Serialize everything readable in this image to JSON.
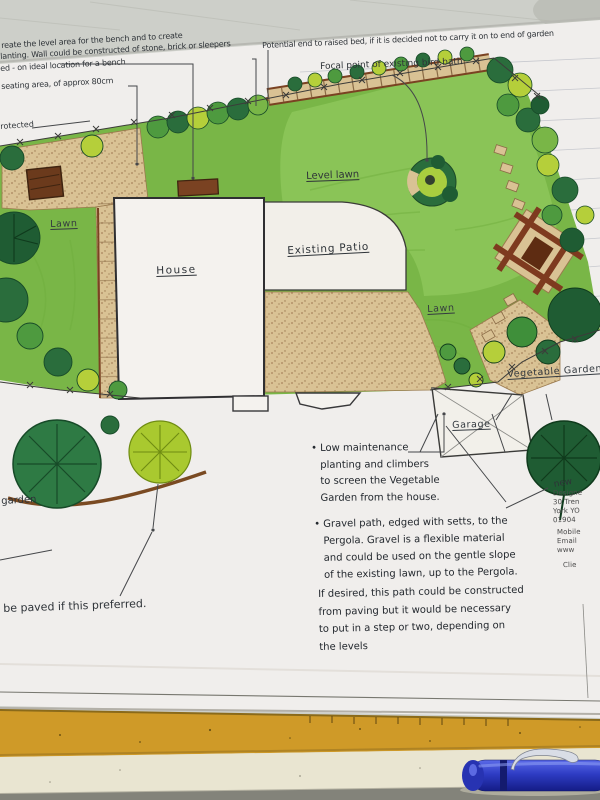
{
  "handwritten": {
    "top_left_lines": [
      "reate the level area for the bench and to create",
      "lanting. Wall could be constructed of stone, brick or sleepers",
      "ed - on ideal location for a bench",
      "seating area, of approx 80cm"
    ],
    "protected_fragment": "rotected",
    "potential_end_note": "Potential end to raised bed, if it is decided not to carry it on to end of garden",
    "focal_point_note": "Focal point of existing bird bath",
    "garden_fragment": "garden",
    "new_fragment": "new",
    "paved_note": "be paved if this preferred."
  },
  "labels": {
    "lawn_left": "Lawn",
    "level_lawn": "Level lawn",
    "house": "House",
    "existing_patio": "Existing Patio",
    "lawn_right": "Lawn",
    "vegetable_garden": "Vegetable Garden",
    "garage": "Garage"
  },
  "notes": {
    "note1_lines": [
      "• Low maintenance",
      "planting and climbers",
      "to screen the Vegetable",
      "Garden from the house."
    ],
    "note2_lines": [
      "• Gravel path, edged with setts,  to the",
      "Pergola. Gravel is a flexible material",
      "and could be used on the gentle slope",
      "of the existing lawn, up to the Pergola."
    ],
    "note3_lines": [
      "If desired, this path could be constructed",
      "from paving but it would be necessary",
      "to put in a step or two, depending on",
      "the levels"
    ]
  },
  "title_block": {
    "lines": [
      "Designe",
      "30 Tren",
      "York YO",
      "01904",
      "Mobile",
      "Email",
      "www",
      "Clie"
    ]
  },
  "colors": {
    "paper": "#f0eeec",
    "table": "#cdcfc9",
    "lawn": "#79b647",
    "level_lawn": "#8ac457",
    "tree_dark": "#1f5c33",
    "tree_mid": "#3f8f3a",
    "tree_light": "#b5cf3a",
    "gravel": "#d9c294",
    "timber": "#7a4222",
    "ink": "#2e3338",
    "ruler": "#cf9a28",
    "pen_blue": "#2e3cc4"
  }
}
